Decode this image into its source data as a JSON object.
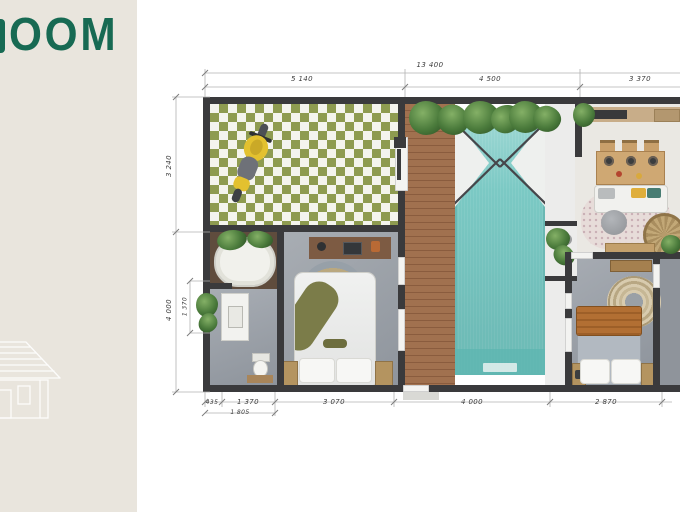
{
  "brand": {
    "visible_text": "OOM",
    "text_color": "#176a53",
    "panel_color": "#e9e5dd"
  },
  "plan": {
    "dims": {
      "top_overall": "13 400",
      "top_segments": [
        "5 140",
        "4 500",
        "3 370"
      ],
      "left_segments": [
        "3 240",
        "4 000"
      ],
      "left_inner": "1 370",
      "bottom_segments": [
        "435",
        "1 370",
        "3 070",
        "4 000",
        "2 870"
      ],
      "bottom_inner": "1 805"
    },
    "colors": {
      "wall": "#3a3a3c",
      "pool_water": "#7bc9c4",
      "carport_tile_green": "#8e9b50",
      "deck_wood": "#9c6e50",
      "concrete_floor": "#9fa5ac",
      "scooter_yellow": "#e3c12f"
    }
  }
}
